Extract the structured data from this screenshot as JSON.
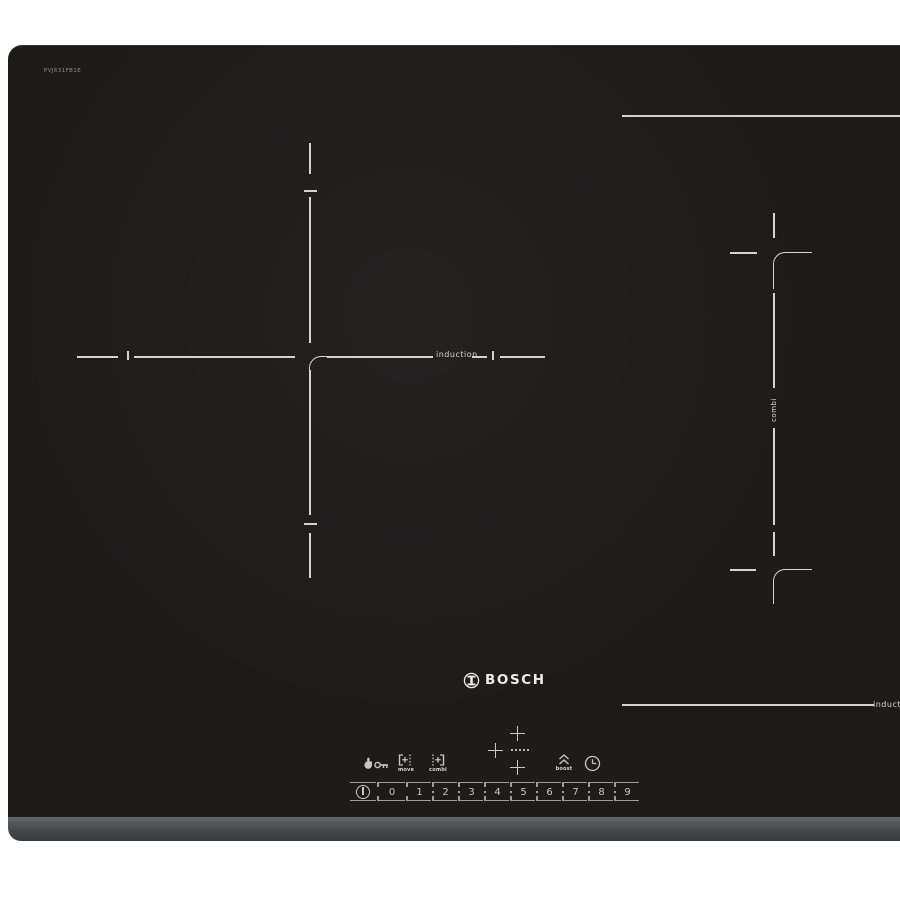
{
  "product": {
    "brand": "BOSCH",
    "model": "PVJ631FB1E"
  },
  "zones": {
    "left_label": "induction",
    "right_side_label": "combi",
    "bottom_right_label": "induction"
  },
  "controls": {
    "child_lock_icon": "hand-key-child-lock",
    "move_label": "move",
    "combi_label": "combi",
    "boost_label": "boost",
    "timer_icon": "clock-timer",
    "power_icon": "power-circle-bar"
  },
  "slider": {
    "levels": [
      "0",
      "1",
      "2",
      "3",
      "4",
      "5",
      "6",
      "7",
      "8",
      "9"
    ],
    "separator_dot": "·"
  },
  "colors": {
    "glass": "#1e1c1b",
    "markings": "#d5d3d1",
    "bevel_top": "#616365",
    "bevel_bottom": "#393a3c",
    "background": "#ffffff"
  }
}
